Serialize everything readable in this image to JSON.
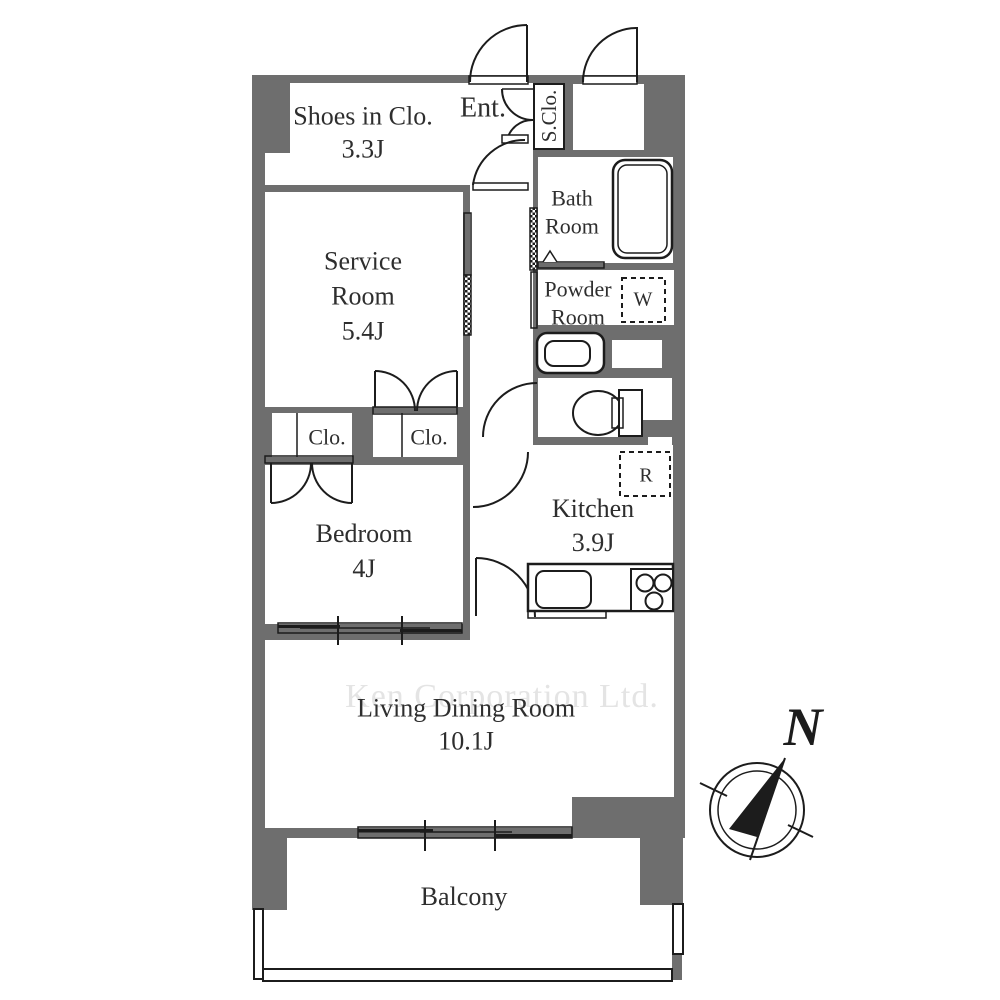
{
  "title": "Apartment floor plan",
  "colors": {
    "wall": "#6e6e6e",
    "floor": "#ffffff",
    "line": "#1c1c1c",
    "ink": "#2e2e2e",
    "wm": "#e4e4e4",
    "bg": "#ffffff"
  },
  "rooms": {
    "shoes_in_closet": {
      "label": "Shoes in Clo.",
      "size": "3.3J"
    },
    "entrance": {
      "label": "Ent."
    },
    "shoe_closet": {
      "label": "S.Clo."
    },
    "bath_room": {
      "line1": "Bath",
      "line2": "Room"
    },
    "powder_room": {
      "line1": "Powder",
      "line2": "Room"
    },
    "washing_machine": {
      "label": "W"
    },
    "service_room": {
      "line1": "Service",
      "line2": "Room",
      "size": "5.4J"
    },
    "closet_left": {
      "label": "Clo."
    },
    "closet_right": {
      "label": "Clo."
    },
    "bedroom": {
      "label": "Bedroom",
      "size": "4J"
    },
    "kitchen": {
      "label": "Kitchen",
      "size": "3.9J"
    },
    "refrigerator": {
      "label": "R"
    },
    "living_dining": {
      "label": "Living Dining Room",
      "size": "10.1J"
    },
    "balcony": {
      "label": "Balcony"
    }
  },
  "watermark": "Ken Corporation Ltd.",
  "compass": {
    "north_label": "N"
  }
}
